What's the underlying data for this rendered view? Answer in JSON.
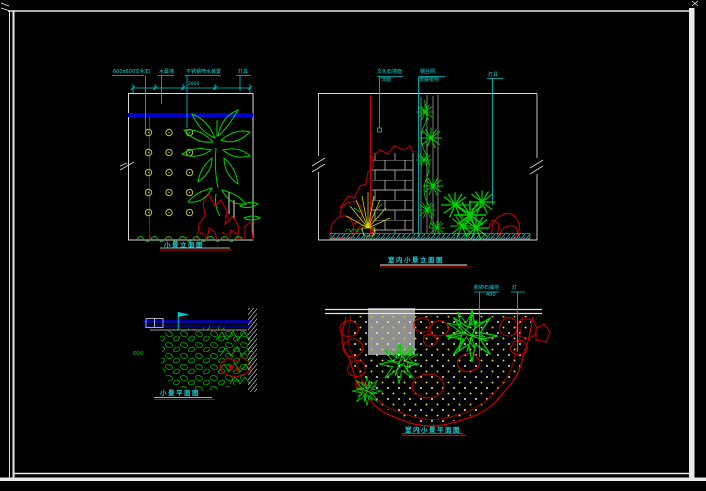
{
  "sheet": {
    "background": "#000000",
    "frame_color": "#e8e8e8"
  },
  "colors": {
    "cyan": "#1ad2d2",
    "blue": "#0000cc",
    "red": "#c80000",
    "green": "#00d200",
    "yellow": "#d8d800",
    "gray": "#8f8f8f",
    "olive_circle": "#b8c24a",
    "white": "#e8e8e8"
  },
  "panels": {
    "tl": {
      "title": "小景立面图",
      "dim": "2800",
      "labels": [
        "600x600文化石",
        "水幕墙",
        "不锈钢喷水装置",
        "灯具"
      ]
    },
    "tr": {
      "title": "室内小景立面图",
      "labels": [
        {
          "line1": "文化石墙面",
          "line2": "饰面"
        },
        {
          "line1": "钢丝网",
          "line2": "爬藤植物"
        },
        {
          "line1": "灯具"
        }
      ]
    },
    "bl": {
      "title": "小景平面图",
      "note": "Ø20"
    },
    "br": {
      "title": "室内小景平面图",
      "labels": [
        {
          "line1": "鹅卵石铺地",
          "line2": "400"
        },
        {
          "line1": "灯"
        }
      ]
    }
  }
}
